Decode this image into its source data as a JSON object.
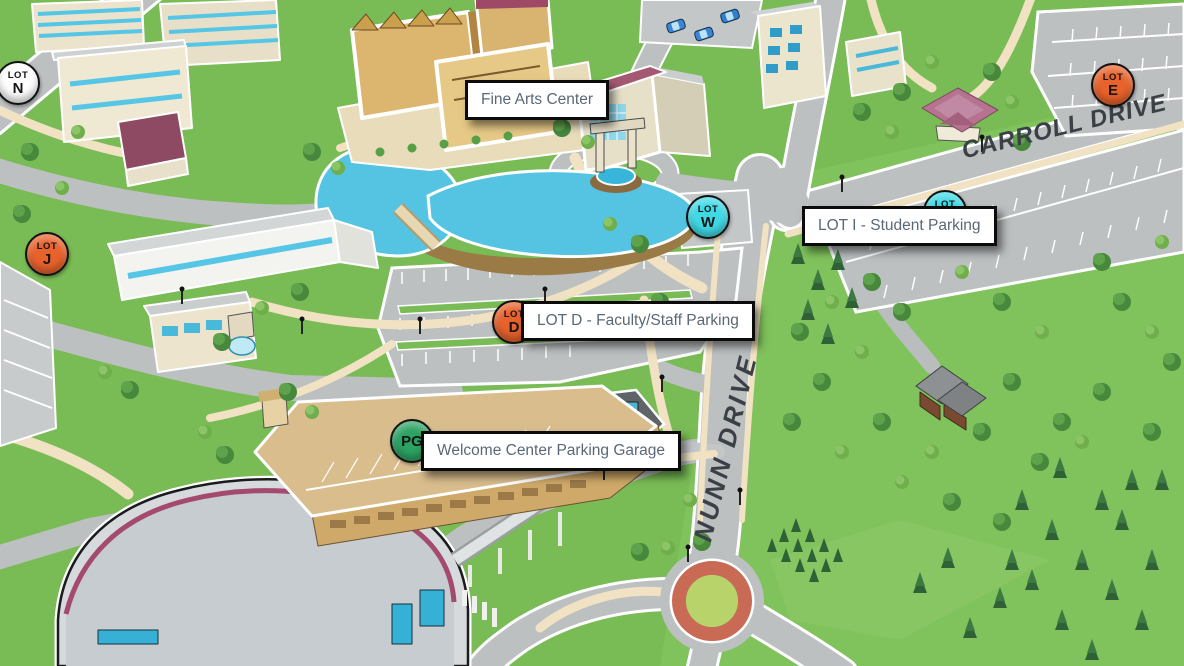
{
  "map": {
    "name": "Illustrated campus map",
    "road_names": [
      "NUNN DRIVE",
      "CARROLL DRIVE"
    ],
    "labels": [
      {
        "id": "fine-arts-center",
        "text": "Fine Arts Center"
      },
      {
        "id": "lot-i-student-parking",
        "text": "LOT I - Student Parking"
      },
      {
        "id": "lot-d-faculty-staff-parking",
        "text": "LOT D - Faculty/Staff Parking"
      },
      {
        "id": "welcome-center-parking-garage",
        "text": "Welcome Center Parking Garage"
      }
    ],
    "markers": [
      {
        "id": "lot-n",
        "top": "LOT",
        "main": "N",
        "color": "#fdfdfd"
      },
      {
        "id": "lot-j",
        "top": "LOT",
        "main": "J",
        "color": "#e8622c"
      },
      {
        "id": "lot-d",
        "top": "LOT",
        "main": "D",
        "color": "#e8622c"
      },
      {
        "id": "lot-w",
        "top": "LOT",
        "main": "W",
        "color": "#3fd9e6"
      },
      {
        "id": "lot-i",
        "top": "LOT",
        "main": "I",
        "color": "#3fd9e6"
      },
      {
        "id": "lot-e",
        "top": "LOT",
        "main": "E",
        "color": "#e8622c"
      },
      {
        "id": "pg",
        "top": "",
        "main": "PG",
        "color": "#2ca362"
      }
    ],
    "palette": {
      "grass": "#79bb55",
      "road": "#bcc0c1",
      "water": "#55c4e3",
      "path": "#f0e2c2",
      "label_text": "#5a6876",
      "roundabout_ring": "#c96b54",
      "building_tan": "#dcb66e",
      "arena_roof": "#d6dadc"
    }
  }
}
